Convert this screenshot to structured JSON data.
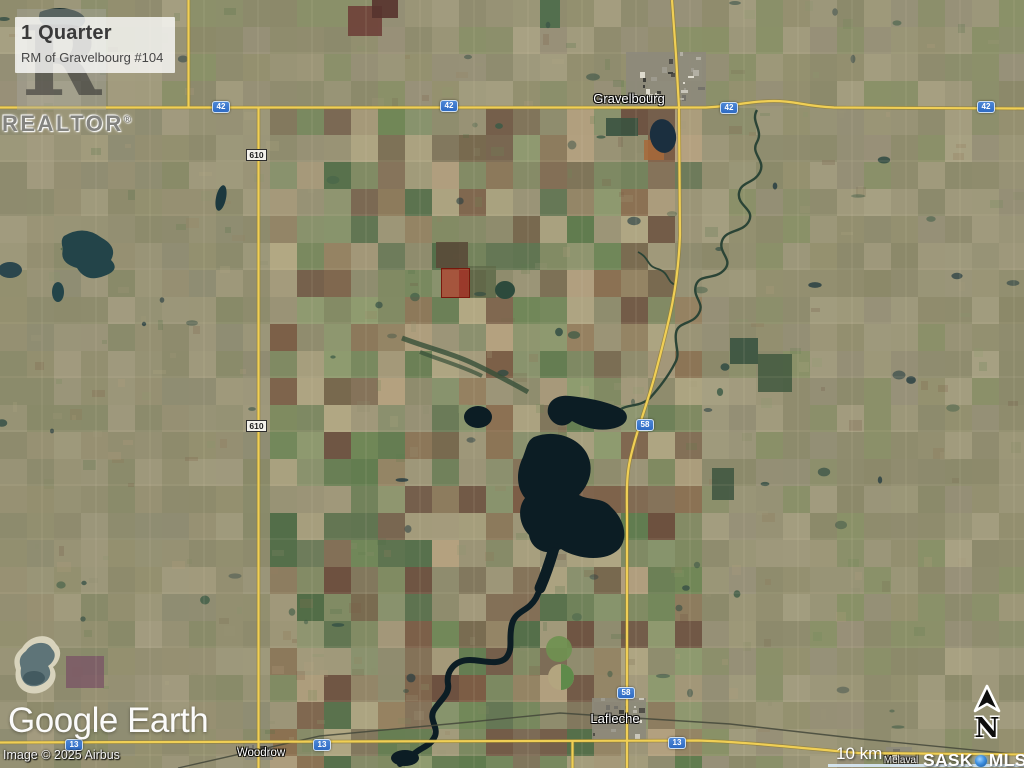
{
  "listing": {
    "title": "1 Quarter",
    "subtitle": "RM of Gravelbourg #104"
  },
  "watermark": {
    "letter": "R",
    "label": "REALTOR",
    "reg": "®"
  },
  "footer": {
    "logo": "Google Earth",
    "credit": "Image © 2025 Airbus"
  },
  "scalebar": {
    "label": "10 km"
  },
  "mls": {
    "prefix": "SASK",
    "suffix": "MLS",
    "reg": "®"
  },
  "compass": {
    "label": "N"
  },
  "towns": [
    {
      "name": "Gravelbourg"
    },
    {
      "name": "Lafleche"
    },
    {
      "name": "Woodrow"
    },
    {
      "name": "Melaval"
    }
  ],
  "highway_shields": [
    {
      "number": "42",
      "type": "provincial"
    },
    {
      "number": "42",
      "type": "provincial"
    },
    {
      "number": "42",
      "type": "provincial"
    },
    {
      "number": "42",
      "type": "provincial"
    },
    {
      "number": "610",
      "type": "secondary"
    },
    {
      "number": "610",
      "type": "secondary"
    },
    {
      "number": "58",
      "type": "provincial"
    },
    {
      "number": "58",
      "type": "provincial"
    },
    {
      "number": "13",
      "type": "provincial"
    },
    {
      "number": "13",
      "type": "provincial"
    },
    {
      "number": "13",
      "type": "provincial"
    }
  ],
  "map": {
    "base_color": "#908d71",
    "road_yellow": "#f0cf55",
    "road_casing": "#8f7b30",
    "water_color": "#0c1d24",
    "river_color": "#2b4436",
    "railway_color": "#43463a",
    "gridline_color": "rgba(218,208,178,0.22)",
    "shield_blue": "#2e6bc4",
    "parcel_fill": "rgba(187,34,22,0.55)",
    "parcel_stroke": "rgba(118,18,8,0.9)",
    "palette_west": [
      "#94906f",
      "#9a9577",
      "#8d8b6c",
      "#a19b7d",
      "#8f8d73",
      "#989173",
      "#888a68",
      "#a39c80"
    ],
    "palette_mid": [
      "#8f8c6d",
      "#7e8a60",
      "#6f8757",
      "#a49b7c",
      "#b2a884",
      "#8b7051",
      "#7b5c45",
      "#968160",
      "#5e7b4d",
      "#4f6c46",
      "#87946c",
      "#9d9678",
      "#b4a180",
      "#6c503f",
      "#8e9c6f",
      "#77684e"
    ],
    "palette_east": [
      "#95916f",
      "#9d9879",
      "#8f8c6d",
      "#a39d7f",
      "#899167",
      "#989179",
      "#8b8969",
      "#a8a183"
    ],
    "town_greys": [
      "#c9c6ba",
      "#74726a",
      "#514f48",
      "#b2afa3",
      "#3f3f39",
      "#9e9b8f",
      "#dedbce"
    ]
  }
}
